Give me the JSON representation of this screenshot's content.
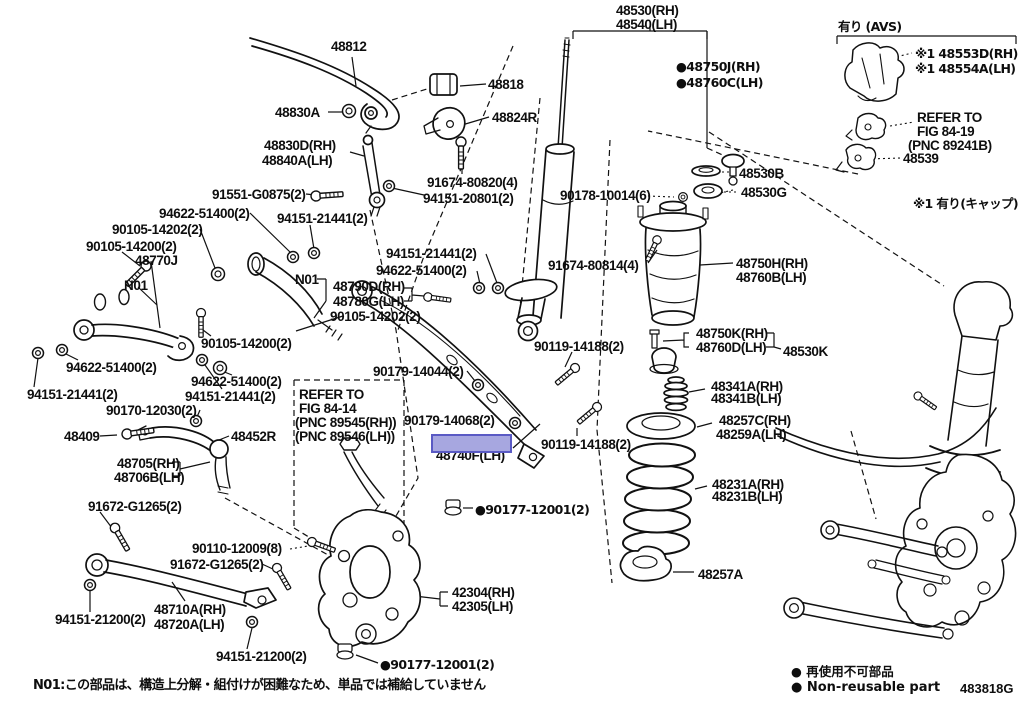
{
  "diagram_code": "483818G",
  "footer_note": "N01:この部品は、構造上分解・組付けが困難なため、単品では補給していません",
  "legend": {
    "jp": "● 再使用不可部品",
    "en": "● Non-reusable part"
  },
  "highlight": {
    "color": "#a7a7e0",
    "border": "#5a5ac4",
    "part_under": "48740F(LH)"
  },
  "avs": {
    "header": "有り (AVS)",
    "cap_note": "※1 有り(キャップ)",
    "refer": [
      "REFER TO",
      "FIG 84-19",
      "(PNC 89241B)"
    ]
  },
  "refer_fig_84_14": [
    "REFER TO",
    "FIG 84-14",
    "(PNC 89545(RH))",
    "(PNC 89546(LH))"
  ],
  "labels": [
    {
      "t": "48812",
      "x": 331,
      "y": 40
    },
    {
      "t": "48818",
      "x": 488,
      "y": 78
    },
    {
      "t": "48830A",
      "x": 275,
      "y": 106
    },
    {
      "t": "48824R",
      "x": 492,
      "y": 111
    },
    {
      "t": "48830D(RH)",
      "x": 264,
      "y": 139
    },
    {
      "t": "48840A(LH)",
      "x": 262,
      "y": 154
    },
    {
      "t": "91674-80820(4)",
      "x": 427,
      "y": 176
    },
    {
      "t": "94151-20801(2)",
      "x": 423,
      "y": 192
    },
    {
      "t": "91551-G0875(2)",
      "x": 212,
      "y": 188
    },
    {
      "t": "94622-51400(2)",
      "x": 159,
      "y": 207
    },
    {
      "t": "90105-14202(2)",
      "x": 112,
      "y": 223
    },
    {
      "t": "90105-14200(2)",
      "x": 86,
      "y": 240
    },
    {
      "t": "48770J",
      "x": 135,
      "y": 254
    },
    {
      "t": "N01",
      "x": 124,
      "y": 279
    },
    {
      "t": "94151-21441(2)",
      "x": 277,
      "y": 212
    },
    {
      "t": "N01",
      "x": 295,
      "y": 273
    },
    {
      "t": "48790D(RH)",
      "x": 333,
      "y": 280
    },
    {
      "t": "48780G(LH)",
      "x": 333,
      "y": 295
    },
    {
      "t": "90105-14202(2)",
      "x": 330,
      "y": 310
    },
    {
      "t": "90105-14200(2)",
      "x": 201,
      "y": 337
    },
    {
      "t": "94151-21441(2)",
      "x": 386,
      "y": 247
    },
    {
      "t": "94622-51400(2)",
      "x": 376,
      "y": 264
    },
    {
      "t": "94622-51400(2)",
      "x": 66,
      "y": 361
    },
    {
      "t": "94151-21441(2)",
      "x": 27,
      "y": 388
    },
    {
      "t": "94622-51400(2)",
      "x": 191,
      "y": 375
    },
    {
      "t": "94151-21441(2)",
      "x": 185,
      "y": 390
    },
    {
      "t": "90170-12030(2)",
      "x": 106,
      "y": 404
    },
    {
      "t": "48409",
      "x": 64,
      "y": 430
    },
    {
      "t": "48452R",
      "x": 231,
      "y": 430
    },
    {
      "t": "48705(RH)",
      "x": 117,
      "y": 457
    },
    {
      "t": "48706B(LH)",
      "x": 114,
      "y": 471
    },
    {
      "t": "91672-G1265(2)",
      "x": 88,
      "y": 500
    },
    {
      "t": "48530(RH)",
      "x": 616,
      "y": 4
    },
    {
      "t": "48540(LH)",
      "x": 616,
      "y": 18
    },
    {
      "t": "●48750J(RH)",
      "x": 676,
      "y": 60,
      "c": "jp"
    },
    {
      "t": "●48760C(LH)",
      "x": 676,
      "y": 76,
      "c": "jp"
    },
    {
      "t": "90178-10014(6)",
      "x": 560,
      "y": 189
    },
    {
      "t": "91674-80814(4)",
      "x": 548,
      "y": 259
    },
    {
      "t": "90119-14188(2)",
      "x": 534,
      "y": 340
    },
    {
      "t": "90179-14044(2)",
      "x": 373,
      "y": 365
    },
    {
      "t": "90179-14068(2)",
      "x": 404,
      "y": 414
    },
    {
      "t": "48740F(LH)",
      "x": 436,
      "y": 449
    },
    {
      "t": "90119-14188(2)",
      "x": 541,
      "y": 438
    },
    {
      "t": "REFER TO",
      "x": 299,
      "y": 388
    },
    {
      "t": "FIG 84-14",
      "x": 299,
      "y": 402
    },
    {
      "t": "(PNC 89545(RH))",
      "x": 295,
      "y": 416
    },
    {
      "t": "(PNC 89546(LH))",
      "x": 295,
      "y": 430
    },
    {
      "t": "●90177-12001(2)",
      "x": 475,
      "y": 503,
      "c": "jp"
    },
    {
      "t": "90110-12009(8)",
      "x": 192,
      "y": 542
    },
    {
      "t": "91672-G1265(2)",
      "x": 170,
      "y": 558
    },
    {
      "t": "42304(RH)",
      "x": 452,
      "y": 586
    },
    {
      "t": "42305(LH)",
      "x": 452,
      "y": 600
    },
    {
      "t": "48710A(RH)",
      "x": 154,
      "y": 603
    },
    {
      "t": "48720A(LH)",
      "x": 154,
      "y": 618
    },
    {
      "t": "94151-21200(2)",
      "x": 55,
      "y": 613
    },
    {
      "t": "94151-21200(2)",
      "x": 216,
      "y": 650
    },
    {
      "t": "●90177-12001(2)",
      "x": 380,
      "y": 658,
      "c": "jp"
    },
    {
      "t": "48530B",
      "x": 739,
      "y": 167
    },
    {
      "t": "48530G",
      "x": 741,
      "y": 186
    },
    {
      "t": "48750H(RH)",
      "x": 736,
      "y": 257
    },
    {
      "t": "48760B(LH)",
      "x": 736,
      "y": 271
    },
    {
      "t": "48750K(RH)",
      "x": 696,
      "y": 327
    },
    {
      "t": "48760D(LH)",
      "x": 696,
      "y": 341
    },
    {
      "t": "48530K",
      "x": 783,
      "y": 345
    },
    {
      "t": "48341A(RH)",
      "x": 711,
      "y": 380
    },
    {
      "t": "48341B(LH)",
      "x": 711,
      "y": 392
    },
    {
      "t": "48257C(RH)",
      "x": 719,
      "y": 414
    },
    {
      "t": "48259A(LH)",
      "x": 716,
      "y": 428
    },
    {
      "t": "48231A(RH)",
      "x": 712,
      "y": 478
    },
    {
      "t": "48231B(LH)",
      "x": 712,
      "y": 490
    },
    {
      "t": "48257A",
      "x": 698,
      "y": 568
    },
    {
      "t": "有り (AVS)",
      "x": 838,
      "y": 20,
      "c": "jp"
    },
    {
      "t": "※1 48553D(RH)",
      "x": 915,
      "y": 47,
      "c": "jp"
    },
    {
      "t": "※1 48554A(LH)",
      "x": 915,
      "y": 62,
      "c": "jp"
    },
    {
      "t": "REFER TO",
      "x": 917,
      "y": 111
    },
    {
      "t": "FIG 84-19",
      "x": 917,
      "y": 125
    },
    {
      "t": "(PNC 89241B)",
      "x": 908,
      "y": 139
    },
    {
      "t": "48539",
      "x": 903,
      "y": 152
    },
    {
      "t": "※1 有り(キャップ)",
      "x": 913,
      "y": 197,
      "c": "jp"
    }
  ]
}
